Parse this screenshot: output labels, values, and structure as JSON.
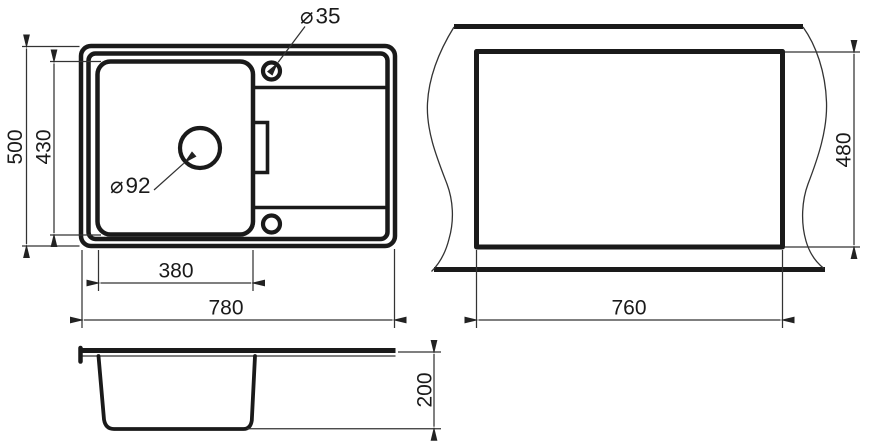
{
  "style": {
    "background": "#ffffff",
    "line_color": "#1a1a1a",
    "dimension_line_color": "#333333"
  },
  "plan_view": {
    "dim_overall_width": "780",
    "dim_overall_depth": "500",
    "dim_bowl_width": "380",
    "dim_bowl_depth": "430",
    "tap_hole_label": {
      "symbol": "⌀",
      "value": "35"
    },
    "drain_label": {
      "symbol": "⌀",
      "value": "92"
    }
  },
  "cutout_view": {
    "dim_width": "760",
    "dim_height": "480"
  },
  "side_view": {
    "dim_depth": "200"
  }
}
